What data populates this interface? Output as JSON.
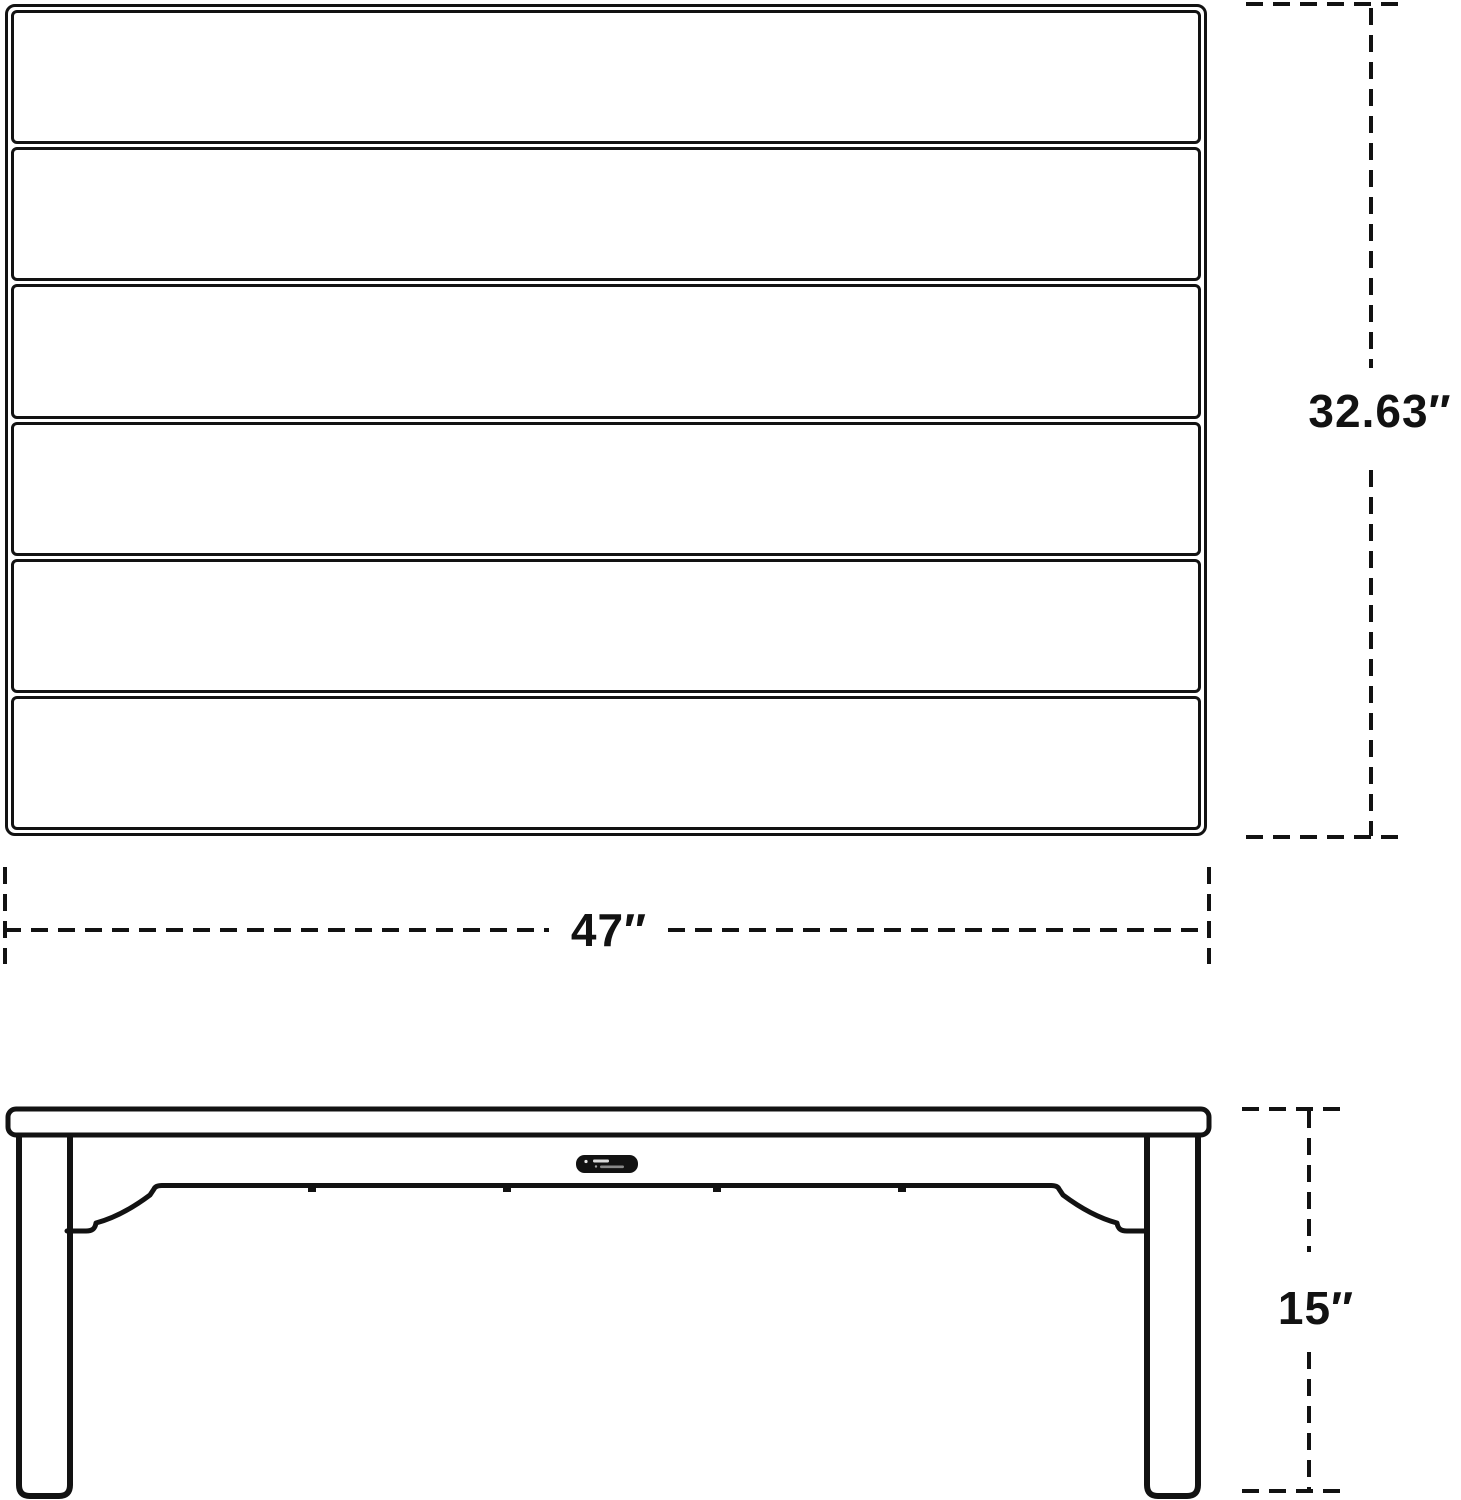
{
  "canvas": {
    "background": "#ffffff",
    "line_color": "#121212"
  },
  "views": {
    "top": {
      "slat_count": 6
    },
    "side": {
      "brand_badge": true,
      "leg_count": 2
    }
  },
  "dimensions": {
    "depth": {
      "label": "32.63″"
    },
    "width": {
      "label": "47″"
    },
    "height": {
      "label": "15″"
    }
  }
}
